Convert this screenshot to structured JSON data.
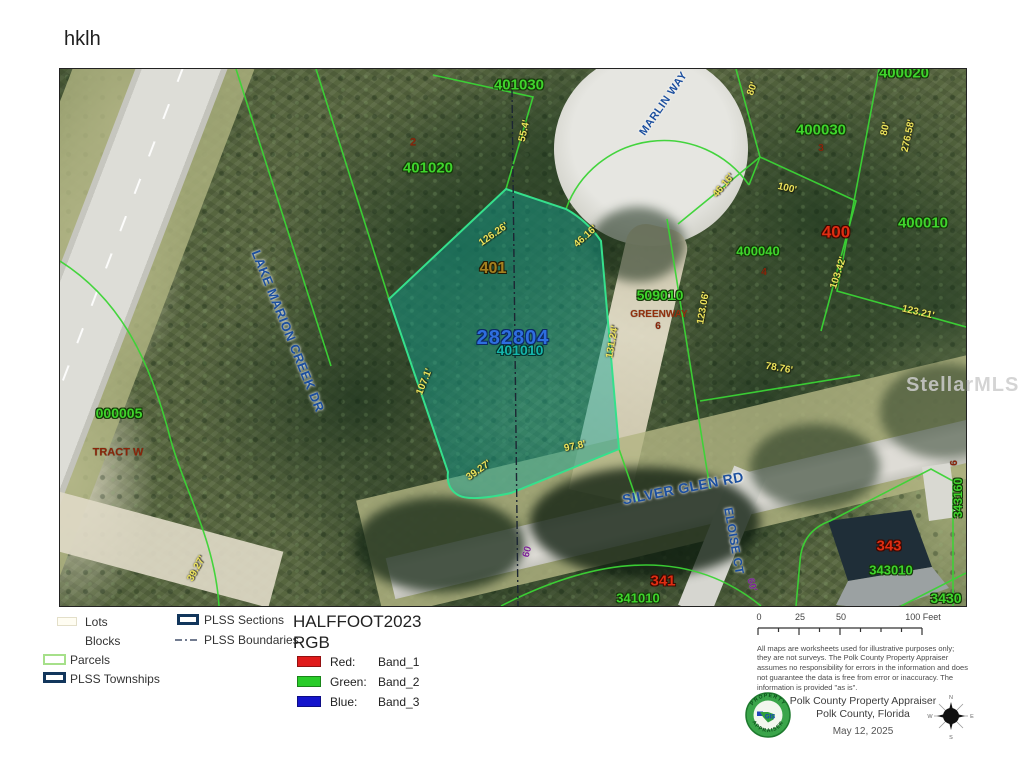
{
  "page": {
    "title": "hklh"
  },
  "map": {
    "watermark": "StellarMLS",
    "palette": {
      "parcel_line": "#3bd435",
      "selected_parcel_fill": "#14aa96",
      "parcel_id_green": "#3fd42c",
      "dimension_yellow": "#ece25c",
      "road_label_blue": "#1c4f9e",
      "block_red": "#df2d12",
      "selected_id_blue": "#2e6ee0",
      "plss_navy": "#12365c"
    },
    "labels": [
      {
        "text": "401030",
        "x": 459,
        "y": 16,
        "size": 15,
        "cls": "green"
      },
      {
        "text": "MARLIN WAY",
        "x": 604,
        "y": 35,
        "size": 11,
        "rot": -55,
        "cls": "road"
      },
      {
        "text": "2",
        "x": 353,
        "y": 74,
        "size": 11,
        "cls": "darkred"
      },
      {
        "text": "401020",
        "x": 368,
        "y": 99,
        "size": 15,
        "cls": "green"
      },
      {
        "text": "55.4'",
        "x": 465,
        "y": 62,
        "size": 10,
        "rot": -78,
        "cls": "dim"
      },
      {
        "text": "400020",
        "x": 844,
        "y": 4,
        "size": 15,
        "cls": "green"
      },
      {
        "text": "80'",
        "x": 693,
        "y": 20,
        "size": 10,
        "rot": -70,
        "cls": "dim"
      },
      {
        "text": "400030",
        "x": 761,
        "y": 61,
        "size": 15,
        "cls": "green"
      },
      {
        "text": "3",
        "x": 761,
        "y": 80,
        "size": 10,
        "cls": "darkred"
      },
      {
        "text": "80'",
        "x": 826,
        "y": 60,
        "size": 10,
        "rot": -78,
        "cls": "dim"
      },
      {
        "text": "276.58'",
        "x": 849,
        "y": 67,
        "size": 10,
        "rot": -78,
        "cls": "dim"
      },
      {
        "text": "126.26'",
        "x": 434,
        "y": 166,
        "size": 10,
        "rot": -35,
        "cls": "dim"
      },
      {
        "text": "46.16'",
        "x": 526,
        "y": 168,
        "size": 10,
        "rot": -42,
        "cls": "dim"
      },
      {
        "text": "401",
        "x": 433,
        "y": 200,
        "size": 16,
        "cls": "olive"
      },
      {
        "text": "46.16'",
        "x": 664,
        "y": 117,
        "size": 10,
        "rot": -50,
        "cls": "dim"
      },
      {
        "text": "100'",
        "x": 727,
        "y": 120,
        "size": 10,
        "rot": 13,
        "cls": "dim"
      },
      {
        "text": "400",
        "x": 776,
        "y": 163,
        "size": 17,
        "cls": "red"
      },
      {
        "text": "400010",
        "x": 863,
        "y": 154,
        "size": 15,
        "cls": "green"
      },
      {
        "text": "400040",
        "x": 698,
        "y": 182,
        "size": 13,
        "cls": "green"
      },
      {
        "text": "4",
        "x": 704,
        "y": 204,
        "size": 10,
        "cls": "darkred"
      },
      {
        "text": "509010",
        "x": 600,
        "y": 226,
        "size": 14,
        "cls": "green"
      },
      {
        "text": "GREENWAY",
        "x": 599,
        "y": 246,
        "size": 10,
        "cls": "greenway"
      },
      {
        "text": "6",
        "x": 598,
        "y": 258,
        "size": 10,
        "cls": "darkred"
      },
      {
        "text": "123.06'",
        "x": 644,
        "y": 239,
        "size": 10,
        "rot": -80,
        "cls": "dim"
      },
      {
        "text": "282804",
        "x": 453,
        "y": 269,
        "size": 20,
        "cls": "blueid"
      },
      {
        "text": "401010",
        "x": 460,
        "y": 281,
        "size": 14,
        "cls": "teal"
      },
      {
        "text": "131.24'",
        "x": 553,
        "y": 273,
        "size": 10,
        "rot": -80,
        "cls": "dim"
      },
      {
        "text": "107.1'",
        "x": 365,
        "y": 313,
        "size": 10,
        "rot": -68,
        "cls": "dim"
      },
      {
        "text": "103.42'",
        "x": 779,
        "y": 204,
        "size": 10,
        "rot": -72,
        "cls": "dim"
      },
      {
        "text": "123.21'",
        "x": 858,
        "y": 244,
        "size": 10,
        "rot": 13,
        "cls": "dim"
      },
      {
        "text": "78.76'",
        "x": 719,
        "y": 300,
        "size": 10,
        "rot": 10,
        "cls": "dim"
      },
      {
        "text": "000005",
        "x": 59,
        "y": 344,
        "size": 14,
        "cls": "green"
      },
      {
        "text": "TRACT W",
        "x": 58,
        "y": 384,
        "size": 11,
        "cls": "darkred"
      },
      {
        "text": "39.27'",
        "x": 137,
        "y": 500,
        "size": 10,
        "rot": -62,
        "cls": "dim"
      },
      {
        "text": "39.27'",
        "x": 419,
        "y": 402,
        "size": 10,
        "rot": -35,
        "cls": "dim"
      },
      {
        "text": "97.8'",
        "x": 515,
        "y": 378,
        "size": 10,
        "rot": -12,
        "cls": "dim"
      },
      {
        "text": "LAKE MARION CREEK DR",
        "x": 228,
        "y": 262,
        "size": 13,
        "rot": 68,
        "cls": "road"
      },
      {
        "text": "SILVER GLEN RD",
        "x": 623,
        "y": 419,
        "size": 14,
        "rot": -11,
        "cls": "road"
      },
      {
        "text": "ELOISE CT",
        "x": 674,
        "y": 472,
        "size": 12,
        "rot": 80,
        "cls": "road"
      },
      {
        "text": "341",
        "x": 603,
        "y": 512,
        "size": 15,
        "cls": "red"
      },
      {
        "text": "341010",
        "x": 578,
        "y": 529,
        "size": 13,
        "cls": "green"
      },
      {
        "text": "343",
        "x": 829,
        "y": 477,
        "size": 15,
        "cls": "red"
      },
      {
        "text": "343010",
        "x": 831,
        "y": 501,
        "size": 13,
        "cls": "green"
      },
      {
        "text": "3430",
        "x": 886,
        "y": 529,
        "size": 14,
        "cls": "green"
      },
      {
        "text": "343160",
        "x": 898,
        "y": 429,
        "size": 12,
        "rot": -90,
        "cls": "green"
      },
      {
        "text": "6",
        "x": 895,
        "y": 394,
        "size": 10,
        "rot": -90,
        "cls": "darkred"
      },
      {
        "text": "60",
        "x": 468,
        "y": 483,
        "size": 10,
        "rot": -75,
        "cls": "purple"
      },
      {
        "text": "60'",
        "x": 691,
        "y": 516,
        "size": 10,
        "rot": 75,
        "cls": "purple"
      }
    ]
  },
  "legend": {
    "col1": [
      {
        "label": "Lots"
      },
      {
        "label": "Blocks"
      },
      {
        "label": "Parcels"
      },
      {
        "label": "PLSS Townships"
      }
    ],
    "col2": [
      {
        "label": "PLSS Sections"
      },
      {
        "label": "PLSS Boundaries"
      }
    ]
  },
  "raster": {
    "title": "HALFFOOT2023",
    "subtitle": "RGB",
    "bands": [
      {
        "name": "Red:",
        "band": "Band_1",
        "color": "#e01b1b"
      },
      {
        "name": "Green:",
        "band": "Band_2",
        "color": "#29cc29"
      },
      {
        "name": "Blue:",
        "band": "Band_3",
        "color": "#1515cc"
      }
    ]
  },
  "scalebar": {
    "labels": [
      "0",
      "25",
      "50",
      "100 Feet"
    ]
  },
  "disclaimer": "All maps are worksheets used for illustrative purposes only; they are not surveys. The Polk County Property Appraiser assumes no responsibility for errors in the information and does not guarantee the data is free from error or inaccuracy. The information is provided \"as is\".",
  "credits": {
    "org": "Polk County Property Appraiser",
    "region": "Polk County, Florida",
    "date": "May 12, 2025"
  },
  "logo": {
    "top": "PROPERTY",
    "bottom": "APPRAISER",
    "gis": "GIS"
  },
  "compass": {
    "n": "N",
    "e": "E",
    "s": "S",
    "w": "W"
  }
}
